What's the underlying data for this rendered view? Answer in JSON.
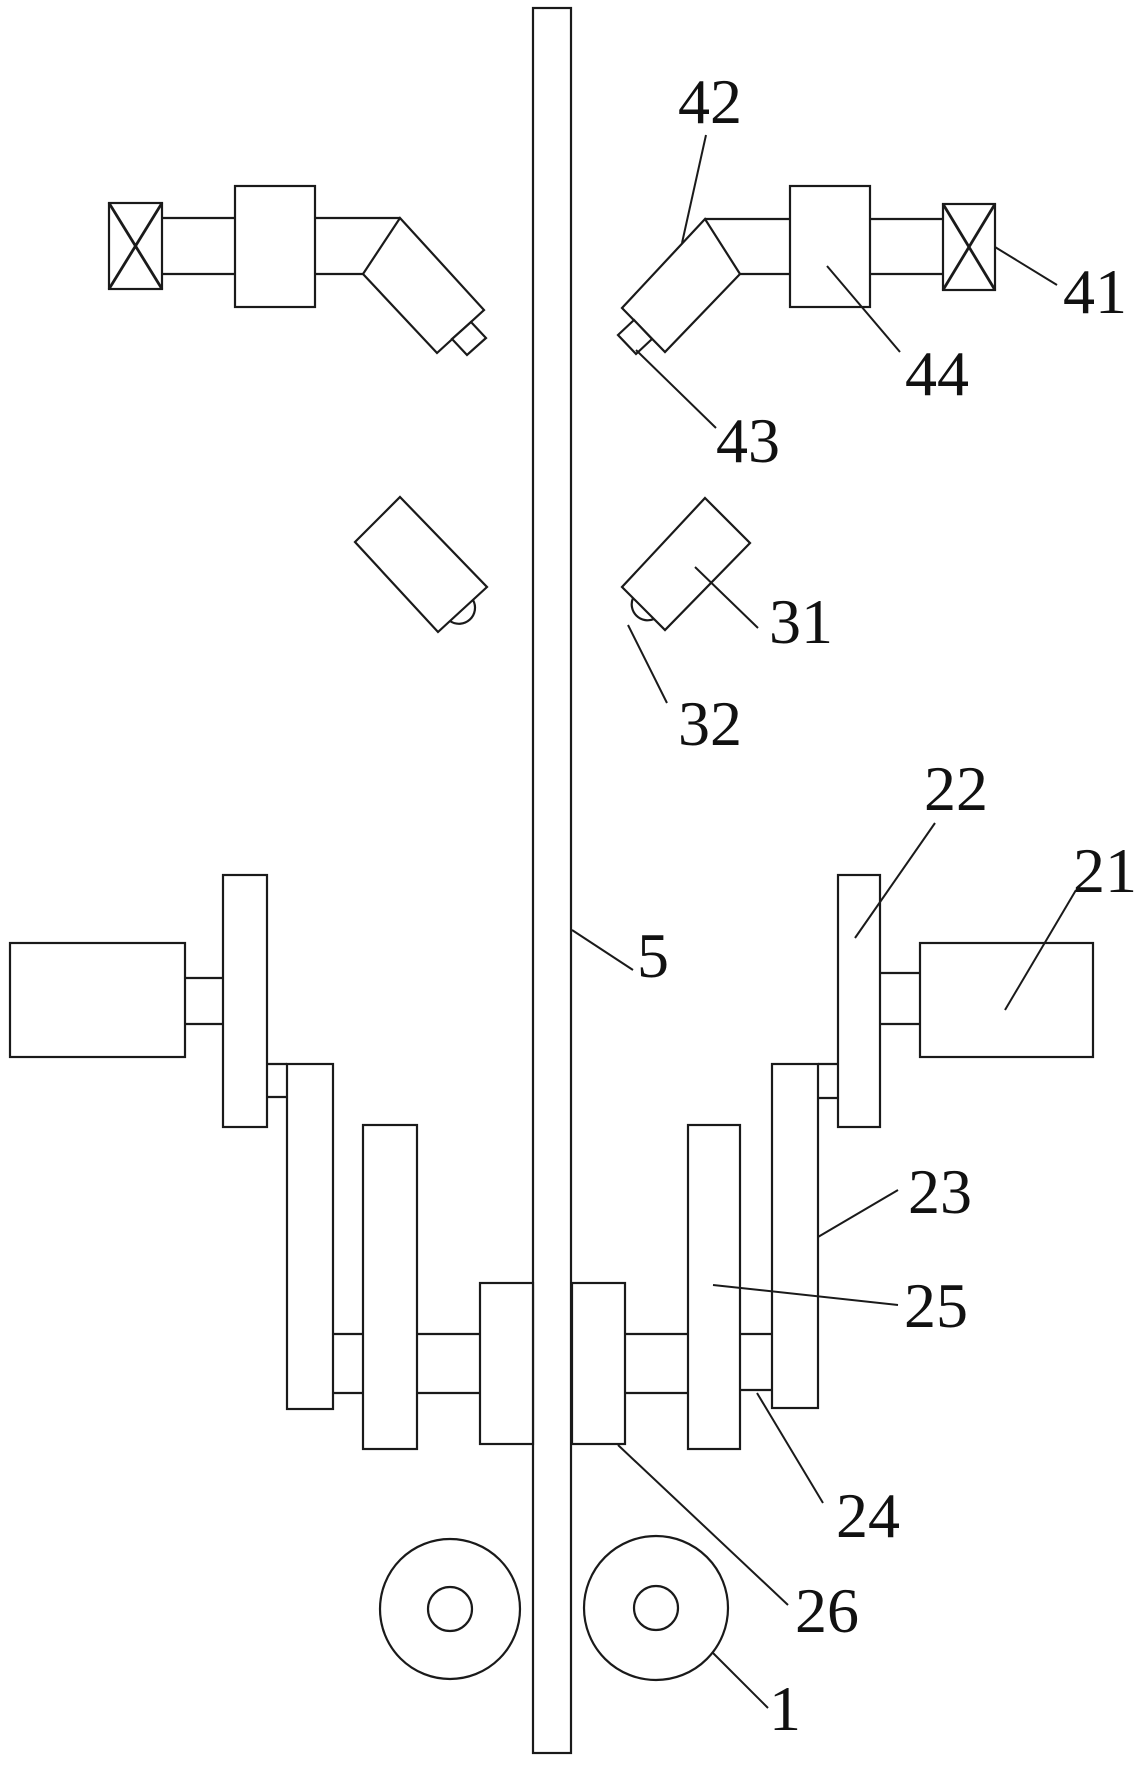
{
  "figure": {
    "kind": "patent-technical-drawing",
    "colors": {
      "background": "#ffffff",
      "line": "#1a1a1a",
      "text": "#111111"
    },
    "labels": {
      "n42": "42",
      "n44": "44",
      "n41": "41",
      "n43": "43",
      "n31": "31",
      "n32": "32",
      "n5": "5",
      "n22": "22",
      "n21": "21",
      "n23": "23",
      "n25": "25",
      "n24": "24",
      "n26": "26",
      "n1": "1"
    }
  }
}
